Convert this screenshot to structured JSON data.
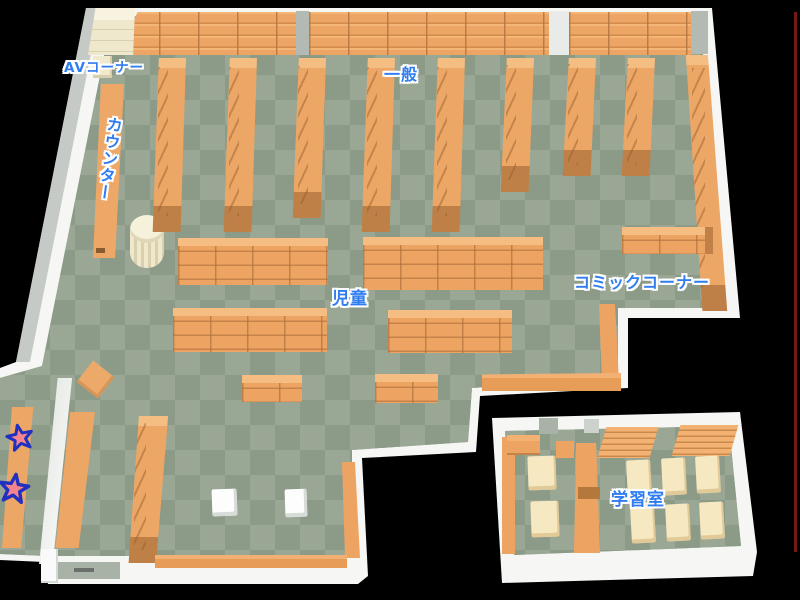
{
  "map": {
    "labels": {
      "av_corner": "AVコーナー",
      "counter": "カウンター",
      "general": "一般",
      "children": "児童",
      "comic_corner": "コミックコーナー",
      "study_room": "学習室"
    },
    "markers": {
      "star_count": 2
    },
    "colors": {
      "label_blue": "#2f7df0",
      "shelf_orange": "#eda463",
      "shelf_cap_brown": "#bf8047",
      "floor_light": "#9ba795",
      "floor_dark": "#8c9a88",
      "wall_white": "#f6f7f4",
      "wood_cream": "#f2ecd2",
      "star_fill": "#f37a84",
      "star_outline": "#2030c0",
      "edge_line_red": "#8b1c1c"
    }
  }
}
